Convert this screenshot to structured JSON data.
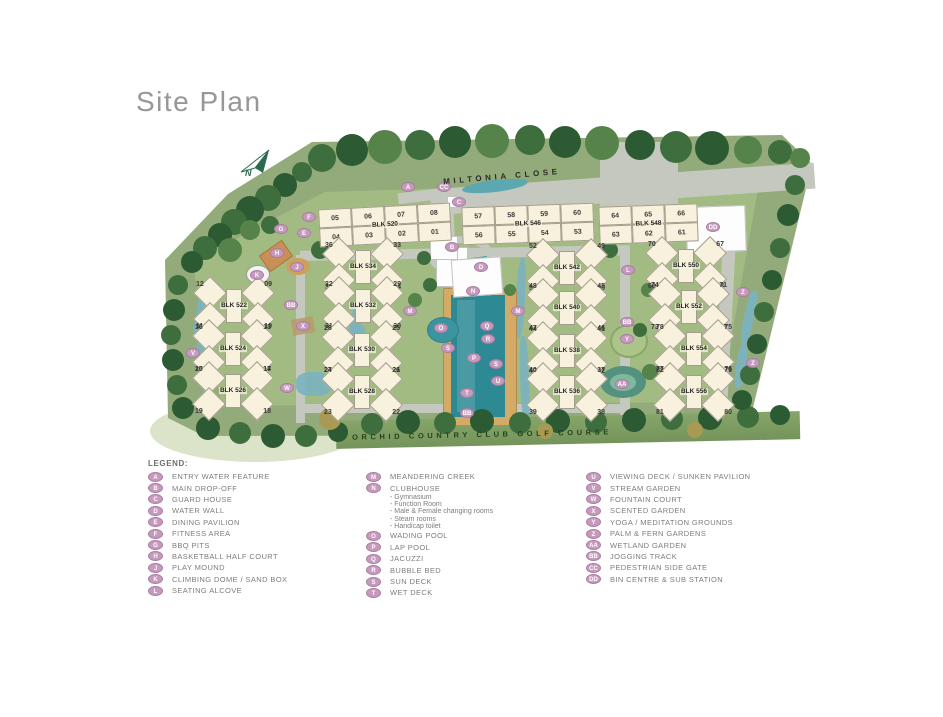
{
  "title": "Site Plan",
  "map": {
    "road_label": "MILTONIA CLOSE",
    "golf_course_label": "ORCHID COUNTRY CLUB GOLF COURSE",
    "north_label": "N",
    "blocks": [
      {
        "name": "BLK 520",
        "type": "row",
        "cx": 385,
        "cy": 225,
        "rot": -3,
        "units_top": [
          "05",
          "06",
          "07",
          "08"
        ],
        "units_bottom": [
          "04",
          "03",
          "02",
          "01"
        ]
      },
      {
        "name": "BLK 546",
        "type": "row",
        "cx": 528,
        "cy": 224,
        "rot": -2,
        "units_top": [
          "57",
          "58",
          "59",
          "60"
        ],
        "units_bottom": [
          "56",
          "55",
          "54",
          "53"
        ]
      },
      {
        "name": "BLK 548",
        "type": "row",
        "cx": 648,
        "cy": 224,
        "rot": -2,
        "units_top": [
          "64",
          "65",
          "66"
        ],
        "units_bottom": [
          "63",
          "62",
          "61"
        ]
      },
      {
        "name": "BLK 534",
        "type": "cluster",
        "cx": 363,
        "cy": 267,
        "units_top": [
          "36",
          "33"
        ],
        "units_bottom": [
          "35",
          "34"
        ]
      },
      {
        "name": "BLK 522",
        "type": "cluster",
        "cx": 234,
        "cy": 306,
        "units_top": [
          "12",
          "09"
        ],
        "units_bottom": [
          "11",
          "10"
        ]
      },
      {
        "name": "BLK 532",
        "type": "cluster",
        "cx": 363,
        "cy": 306,
        "units_top": [
          "32",
          "29"
        ],
        "units_bottom": [
          "31",
          "30"
        ]
      },
      {
        "name": "BLK 524",
        "type": "cluster",
        "cx": 233,
        "cy": 349,
        "units_top": [
          "16",
          "13"
        ],
        "units_bottom": [
          "15",
          "14"
        ]
      },
      {
        "name": "BLK 530",
        "type": "cluster",
        "cx": 362,
        "cy": 350,
        "units_top": [
          "28",
          "25"
        ],
        "units_bottom": [
          "27",
          "26"
        ]
      },
      {
        "name": "BLK 526",
        "type": "cluster",
        "cx": 233,
        "cy": 391,
        "units_top": [
          "20",
          "17"
        ],
        "units_bottom": [
          "19",
          "18"
        ]
      },
      {
        "name": "BLK 528",
        "type": "cluster",
        "cx": 362,
        "cy": 392,
        "units_top": [
          "24",
          "21"
        ],
        "units_bottom": [
          "23",
          "22"
        ]
      },
      {
        "name": "BLK 542",
        "type": "cluster",
        "cx": 567,
        "cy": 268,
        "units_top": [
          "52",
          "49"
        ],
        "units_bottom": [
          "51",
          "50"
        ]
      },
      {
        "name": "BLK 540",
        "type": "cluster",
        "cx": 567,
        "cy": 308,
        "units_top": [
          "48",
          "45"
        ],
        "units_bottom": [
          "47",
          "46"
        ]
      },
      {
        "name": "BLK 538",
        "type": "cluster",
        "cx": 567,
        "cy": 351,
        "units_top": [
          "44",
          "41"
        ],
        "units_bottom": [
          "43",
          "42"
        ]
      },
      {
        "name": "BLK 536",
        "type": "cluster",
        "cx": 567,
        "cy": 392,
        "units_top": [
          "40",
          "37"
        ],
        "units_bottom": [
          "39",
          "38"
        ]
      },
      {
        "name": "BLK 550",
        "type": "cluster",
        "cx": 686,
        "cy": 266,
        "units_top": [
          "70",
          "67"
        ],
        "units_bottom": [
          "69",
          "68"
        ]
      },
      {
        "name": "BLK 552",
        "type": "cluster",
        "cx": 689,
        "cy": 307,
        "units_top": [
          "74",
          "71"
        ],
        "units_bottom": [
          "73",
          "72"
        ]
      },
      {
        "name": "BLK 554",
        "type": "cluster",
        "cx": 694,
        "cy": 349,
        "units_top": [
          "78",
          "75"
        ],
        "units_bottom": [
          "77",
          "76"
        ]
      },
      {
        "name": "BLK 556",
        "type": "cluster",
        "cx": 694,
        "cy": 392,
        "units_top": [
          "82",
          "79"
        ],
        "units_bottom": [
          "81",
          "80"
        ]
      }
    ],
    "markers": [
      {
        "label": "A",
        "x": 408,
        "y": 187
      },
      {
        "label": "CC",
        "x": 444,
        "y": 187
      },
      {
        "label": "C",
        "x": 459,
        "y": 202
      },
      {
        "label": "DD",
        "x": 713,
        "y": 227
      },
      {
        "label": "B",
        "x": 452,
        "y": 247
      },
      {
        "label": "F",
        "x": 309,
        "y": 217
      },
      {
        "label": "G",
        "x": 281,
        "y": 229
      },
      {
        "label": "E",
        "x": 304,
        "y": 233
      },
      {
        "label": "H",
        "x": 277,
        "y": 253
      },
      {
        "label": "J",
        "x": 297,
        "y": 267
      },
      {
        "label": "K",
        "x": 257,
        "y": 275
      },
      {
        "label": "L",
        "x": 628,
        "y": 270
      },
      {
        "label": "D",
        "x": 481,
        "y": 267
      },
      {
        "label": "N",
        "x": 473,
        "y": 291
      },
      {
        "label": "BB",
        "x": 291,
        "y": 305
      },
      {
        "label": "M",
        "x": 410,
        "y": 311
      },
      {
        "label": "M",
        "x": 518,
        "y": 311
      },
      {
        "label": "Z",
        "x": 743,
        "y": 292
      },
      {
        "label": "BB",
        "x": 627,
        "y": 322
      },
      {
        "label": "X",
        "x": 303,
        "y": 326
      },
      {
        "label": "O",
        "x": 441,
        "y": 328
      },
      {
        "label": "Q",
        "x": 487,
        "y": 326
      },
      {
        "label": "Y",
        "x": 627,
        "y": 339
      },
      {
        "label": "R",
        "x": 488,
        "y": 339
      },
      {
        "label": "S",
        "x": 448,
        "y": 348
      },
      {
        "label": "P",
        "x": 474,
        "y": 358
      },
      {
        "label": "S",
        "x": 496,
        "y": 364
      },
      {
        "label": "Z",
        "x": 753,
        "y": 363
      },
      {
        "label": "U",
        "x": 498,
        "y": 381
      },
      {
        "label": "AA",
        "x": 622,
        "y": 384
      },
      {
        "label": "T",
        "x": 467,
        "y": 393
      },
      {
        "label": "BB",
        "x": 467,
        "y": 413
      },
      {
        "label": "V",
        "x": 193,
        "y": 353
      },
      {
        "label": "W",
        "x": 287,
        "y": 388
      }
    ]
  },
  "legend": {
    "heading": "LEGEND:",
    "columns": [
      [
        {
          "key": "A",
          "label": "ENTRY WATER FEATURE"
        },
        {
          "key": "B",
          "label": "MAIN DROP-OFF"
        },
        {
          "key": "C",
          "label": "GUARD HOUSE"
        },
        {
          "key": "D",
          "label": "WATER WALL"
        },
        {
          "key": "E",
          "label": "DINING PAVILION"
        },
        {
          "key": "F",
          "label": "FITNESS AREA"
        },
        {
          "key": "G",
          "label": "BBQ PITS"
        },
        {
          "key": "H",
          "label": "BASKETBALL HALF COURT"
        },
        {
          "key": "J",
          "label": "PLAY MOUND"
        },
        {
          "key": "K",
          "label": "CLIMBING DOME / SAND BOX"
        },
        {
          "key": "L",
          "label": "SEATING ALCOVE"
        }
      ],
      [
        {
          "key": "M",
          "label": "MEANDERING CREEK"
        },
        {
          "key": "N",
          "label": "CLUBHOUSE",
          "sub": [
            "- Gymnasium",
            "- Function Room",
            "- Male & Female changing rooms",
            "- Steam rooms",
            "- Handicap toilet"
          ]
        },
        {
          "key": "O",
          "label": "WADING POOL"
        },
        {
          "key": "P",
          "label": "LAP POOL"
        },
        {
          "key": "Q",
          "label": "JACUZZI"
        },
        {
          "key": "R",
          "label": "BUBBLE BED"
        },
        {
          "key": "S",
          "label": "SUN DECK"
        },
        {
          "key": "T",
          "label": "WET DECK"
        }
      ],
      [
        {
          "key": "U",
          "label": "VIEWING DECK / SUNKEN PAVILION"
        },
        {
          "key": "V",
          "label": "STREAM GARDEN"
        },
        {
          "key": "W",
          "label": "FOUNTAIN COURT"
        },
        {
          "key": "X",
          "label": "SCENTED GARDEN"
        },
        {
          "key": "Y",
          "label": "YOGA / MEDITATION GROUNDS"
        },
        {
          "key": "Z",
          "label": "PALM & FERN GARDENS"
        },
        {
          "key": "AA",
          "label": "WETLAND GARDEN"
        },
        {
          "key": "BB",
          "label": "JOGGING TRACK"
        },
        {
          "key": "CC",
          "label": "PEDESTRIAN SIDE GATE"
        },
        {
          "key": "DD",
          "label": "BIN CENTRE & SUB STATION"
        }
      ]
    ]
  },
  "colors": {
    "marker": "#c699bd",
    "building": "#f7f1dd",
    "pool": "#2d8a94",
    "site_green": "#93ab7a",
    "road": "#c4c8bf",
    "golf_strip": "#7c9c66"
  }
}
